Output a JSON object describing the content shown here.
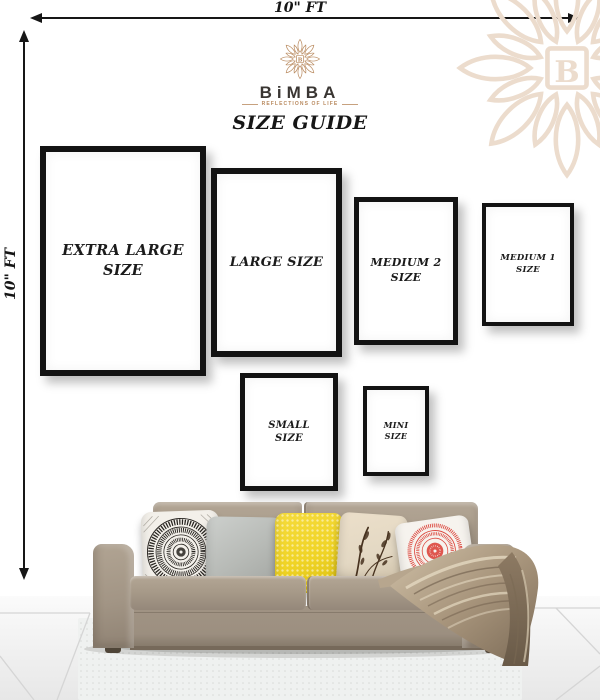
{
  "page": {
    "title": "SIZE GUIDE"
  },
  "dimensions": {
    "width_label": "10\" FT",
    "height_label": "10\" FT"
  },
  "brand": {
    "name": "BiMBA",
    "tagline": "REFLECTIONS OF LIFE",
    "monogram": "B"
  },
  "frames": {
    "extra_large": {
      "line1": "EXTRA LARGE",
      "line2": "SIZE"
    },
    "large": {
      "line1": "LARGE SIZE",
      "line2": ""
    },
    "medium_2": {
      "line1": "MEDIUM 2",
      "line2": "SIZE"
    },
    "medium_1": {
      "line1": "MEDIUM 1",
      "line2": "SIZE"
    },
    "small": {
      "line1": "SMALL",
      "line2": "SIZE"
    },
    "mini": {
      "line1": "MINI",
      "line2": "SIZE"
    }
  },
  "colors": {
    "accent": "#b98a5f",
    "logo_text": "#3a3633",
    "watermark": "#ecdccd",
    "ink": "#161616",
    "frame_border": "#131313",
    "sofa_body": "#a59888",
    "pillow_gray": "#b7bab6",
    "pillow_yellow": "#f0d426",
    "pillow_red": "#dc4a41",
    "pillow_cream": "#e3d8c3",
    "botanical_brown": "#47321f",
    "pillow_bw_ink": "#26231f",
    "throw": "#a4917a",
    "floor_line": "#d5d5d5"
  }
}
